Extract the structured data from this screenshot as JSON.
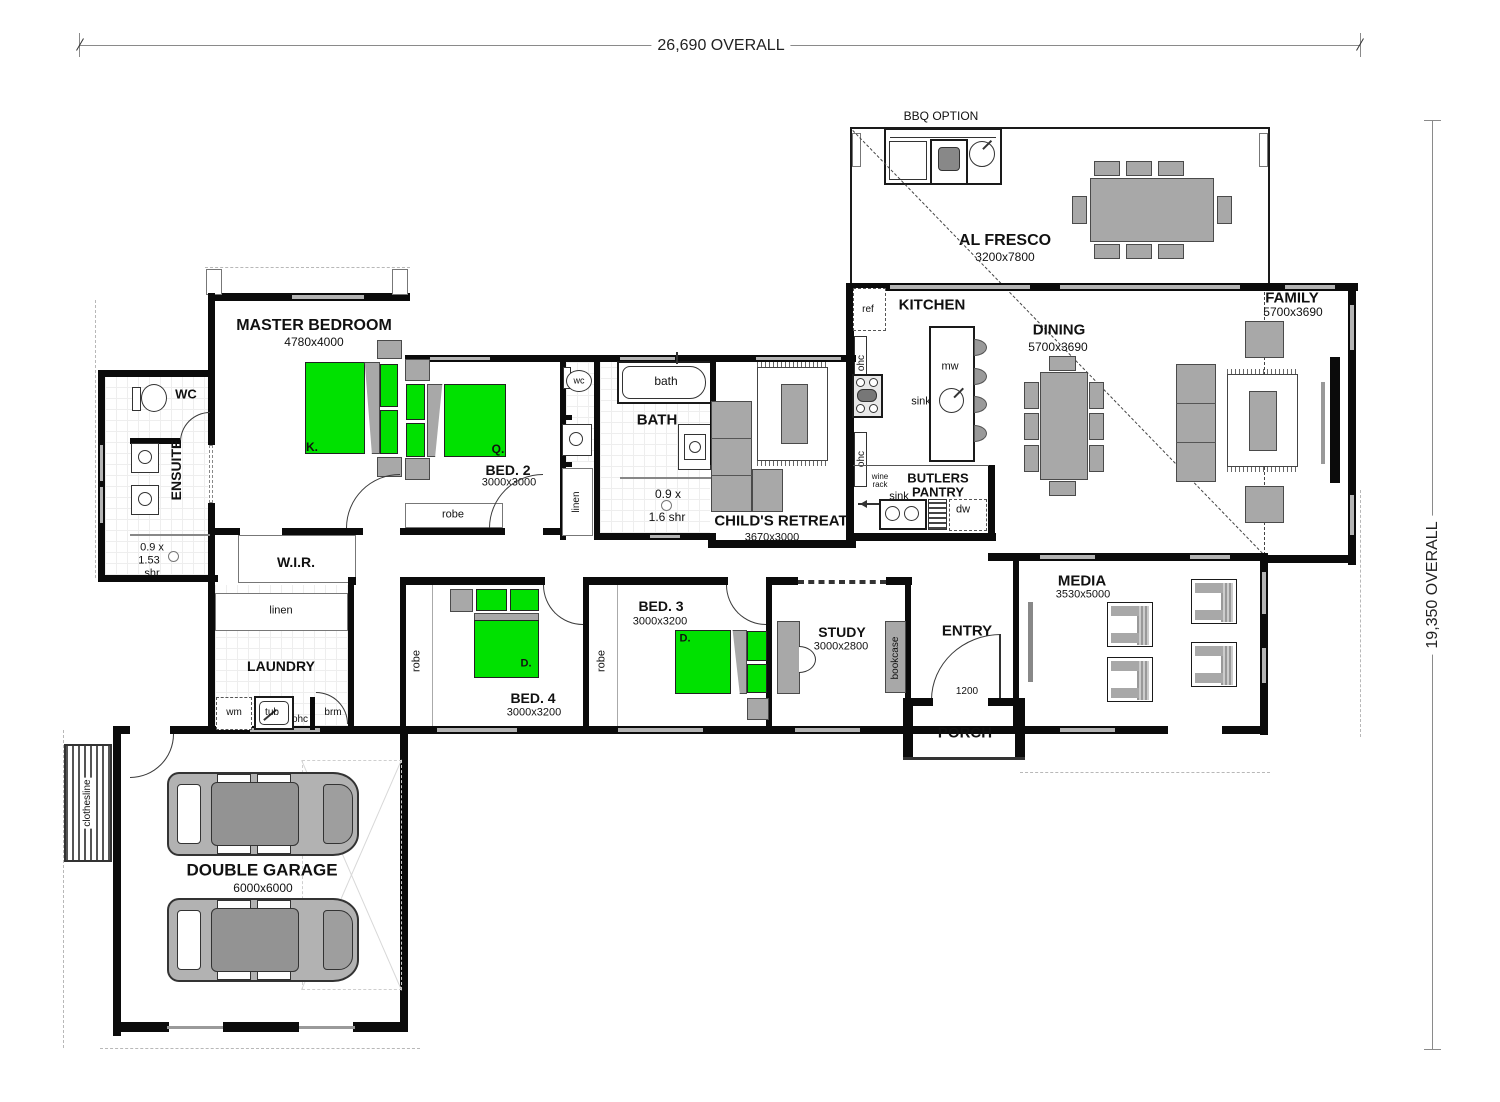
{
  "dimensions": {
    "top": "26,690 OVERALL",
    "right": "19,350 OVERALL"
  },
  "rooms": {
    "al_fresco": {
      "name": "AL FRESCO",
      "size": "3200x7800"
    },
    "bbq": {
      "label": "BBQ OPTION"
    },
    "kitchen": {
      "name": "KITCHEN"
    },
    "butlers": {
      "name1": "BUTLERS",
      "name2": "PANTRY"
    },
    "dining": {
      "name": "DINING",
      "size": "5700x3690"
    },
    "family": {
      "name": "FAMILY",
      "size": "5700x3690"
    },
    "master": {
      "name": "MASTER BEDROOM",
      "size": "4780x4000"
    },
    "ensuite": {
      "name": "ENSUITE",
      "shr1": "0.9 x",
      "shr2": "1.53",
      "shr3": "shr"
    },
    "wc": {
      "name": "WC"
    },
    "wc_small": {
      "name": "wc"
    },
    "wir": {
      "name": "W.I.R."
    },
    "bed2": {
      "name": "BED. 2",
      "size": "3000x3000"
    },
    "bed3": {
      "name": "BED. 3",
      "size": "3000x3200"
    },
    "bed4": {
      "name": "BED. 4",
      "size": "3000x3200"
    },
    "bath": {
      "name": "BATH",
      "tub": "bath",
      "shr1": "0.9 x",
      "shr2": "1.6 shr"
    },
    "childs": {
      "name": "CHILD'S RETREAT",
      "size": "3670x3000"
    },
    "laundry": {
      "name": "LAUNDRY"
    },
    "study": {
      "name": "STUDY",
      "size": "3000x2800"
    },
    "entry": {
      "name": "ENTRY",
      "door": "1200"
    },
    "porch": {
      "name": "PORCH"
    },
    "media": {
      "name": "MEDIA",
      "size": "3530x5000"
    },
    "garage": {
      "name": "DOUBLE GARAGE",
      "size": "6000x6000"
    }
  },
  "fixtures": {
    "ref": "ref",
    "ohc": "ohc",
    "mw": "mw",
    "sink": "sink",
    "wine1": "wine",
    "wine2": "rack",
    "dw": "dw",
    "linen": "linen",
    "robe": "robe",
    "bookcase": "bookcase",
    "wm": "wm",
    "tub": "tub",
    "brm": "brm",
    "clothesline": "clothesline"
  },
  "beds": {
    "king": "K.",
    "queen": "Q.",
    "double": "D."
  },
  "colors": {
    "bed_green": "#00e100",
    "furniture_gray": "#a8a8a8",
    "wall_black": "#0b0b0b"
  }
}
